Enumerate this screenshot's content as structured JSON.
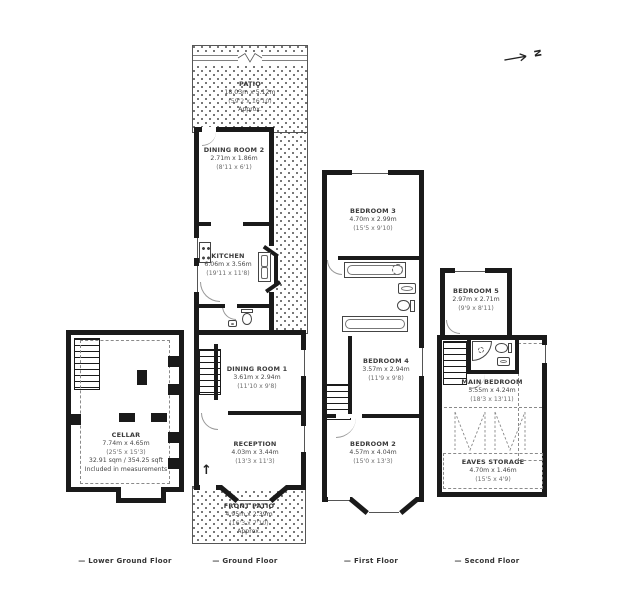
{
  "compass": {
    "north_label": "N"
  },
  "icons": {
    "entrance_arrow": "↑"
  },
  "floors": {
    "lower_ground": {
      "caption": "— Lower Ground Floor",
      "rooms": {
        "cellar": {
          "name": "CELLAR",
          "dims_m": "7.74m x 4.65m",
          "dims_ft": "(25'5 x 15'3)",
          "area": "32.91 sqm / 354.25 sqft",
          "note": "Included in measurements"
        }
      }
    },
    "ground": {
      "caption": "— Ground Floor",
      "rooms": {
        "patio": {
          "name": "PATIO",
          "dims_m": "18.03m x 5.12m",
          "dims_ft": "(59'2 x 16'10)",
          "note": "Approx."
        },
        "dining_room_2": {
          "name": "DINING ROOM 2",
          "dims_m": "2.71m x 1.86m",
          "dims_ft": "(8'11 x 6'1)"
        },
        "kitchen": {
          "name": "KITCHEN",
          "dims_m": "6.06m x 3.56m",
          "dims_ft": "(19'11 x 11'8)"
        },
        "dining_room_1": {
          "name": "DINING ROOM 1",
          "dims_m": "3.61m x 2.94m",
          "dims_ft": "(11'10 x 9'8)"
        },
        "reception": {
          "name": "RECEPTION",
          "dims_m": "4.03m x 3.44m",
          "dims_ft": "(13'3 x 11'3)"
        },
        "front_patio": {
          "name": "FRONT PATIO",
          "dims_m": "4.95m x 2.39m",
          "dims_ft": "(16'3 x 7'10)",
          "note": "Approx."
        }
      }
    },
    "first": {
      "caption": "— First Floor",
      "rooms": {
        "bedroom_3": {
          "name": "BEDROOM 3",
          "dims_m": "4.70m x 2.99m",
          "dims_ft": "(15'5 x 9'10)"
        },
        "bedroom_4": {
          "name": "BEDROOM 4",
          "dims_m": "3.57m x 2.94m",
          "dims_ft": "(11'9 x 9'8)"
        },
        "bedroom_2": {
          "name": "BEDROOM 2",
          "dims_m": "4.57m x 4.04m",
          "dims_ft": "(15'0 x 13'3)"
        }
      }
    },
    "second": {
      "caption": "— Second Floor",
      "rooms": {
        "bedroom_5": {
          "name": "BEDROOM 5",
          "dims_m": "2.97m x 2.71m",
          "dims_ft": "(9'9 x 8'11)"
        },
        "main_bedroom": {
          "name": "MAIN BEDROOM",
          "dims_m": "5.55m x 4.24m",
          "dims_ft": "(18'3 x 13'11)"
        },
        "eaves_storage": {
          "name": "EAVES STORAGE",
          "dims_m": "4.70m x 1.46m",
          "dims_ft": "(15'5 x 4'9)"
        }
      }
    }
  },
  "colors": {
    "wall": "#1a1a1a",
    "text": "#3a3a3a",
    "dots": "#4a4a4a"
  }
}
